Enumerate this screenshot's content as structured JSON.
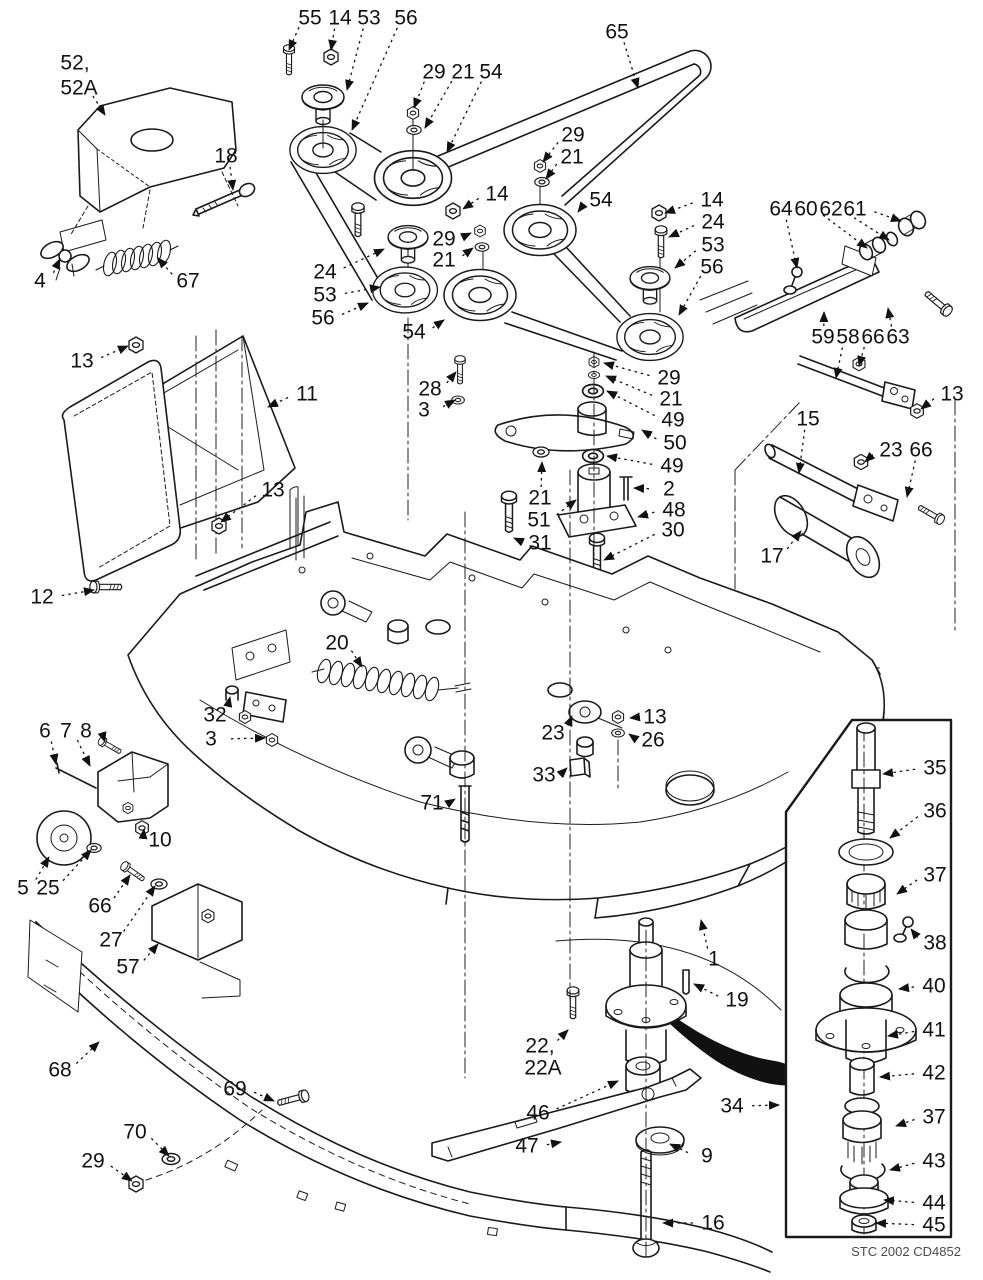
{
  "watermark": {
    "text": "PartsTree",
    "tm": "TM",
    "color": "#c7c7c7"
  },
  "caption": {
    "text": "STC 2002 CD4852"
  },
  "diagram": {
    "line_color": "#1a1a1a",
    "labels": [
      {
        "t": "52,",
        "x": 75,
        "y": 63
      },
      {
        "t": "52A",
        "x": 79,
        "y": 88,
        "ax": 105,
        "ay": 115
      },
      {
        "t": "55",
        "x": 310,
        "y": 18,
        "ax": 289,
        "ay": 50
      },
      {
        "t": "14",
        "x": 340,
        "y": 18,
        "ax": 331,
        "ay": 50
      },
      {
        "t": "53",
        "x": 369,
        "y": 18,
        "ax": 347,
        "ay": 90
      },
      {
        "t": "56",
        "x": 406,
        "y": 18,
        "ax": 352,
        "ay": 130
      },
      {
        "t": "29",
        "x": 434,
        "y": 72,
        "ax": 414,
        "ay": 108
      },
      {
        "t": "21",
        "x": 463,
        "y": 72,
        "ax": 425,
        "ay": 128
      },
      {
        "t": "54",
        "x": 491,
        "y": 72,
        "ax": 447,
        "ay": 152
      },
      {
        "t": "18",
        "x": 226,
        "y": 156,
        "ax": 233,
        "ay": 190
      },
      {
        "t": "65",
        "x": 617,
        "y": 32,
        "ax": 638,
        "ay": 88
      },
      {
        "t": "29",
        "x": 573,
        "y": 135,
        "ax": 543,
        "ay": 162
      },
      {
        "t": "21",
        "x": 572,
        "y": 157,
        "ax": 546,
        "ay": 179
      },
      {
        "t": "14",
        "x": 497,
        "y": 194,
        "ax": 463,
        "ay": 209
      },
      {
        "t": "54",
        "x": 601,
        "y": 200,
        "ax": 578,
        "ay": 212
      },
      {
        "t": "14",
        "x": 712,
        "y": 200,
        "ax": 665,
        "ay": 213
      },
      {
        "t": "24",
        "x": 713,
        "y": 222,
        "ax": 669,
        "ay": 237
      },
      {
        "t": "53",
        "x": 713,
        "y": 245,
        "ax": 675,
        "ay": 268
      },
      {
        "t": "56",
        "x": 712,
        "y": 267,
        "ax": 679,
        "ay": 315
      },
      {
        "t": "64",
        "x": 781,
        "y": 209,
        "ax": 797,
        "ay": 268
      },
      {
        "t": "60",
        "x": 806,
        "y": 209,
        "ax": 867,
        "ay": 248
      },
      {
        "t": "62",
        "x": 831,
        "y": 209,
        "ax": 889,
        "ay": 240
      },
      {
        "t": "61",
        "x": 855,
        "y": 209,
        "ax": 901,
        "ay": 221
      },
      {
        "t": "4",
        "x": 40,
        "y": 281,
        "ax": 60,
        "ay": 259
      },
      {
        "t": "67",
        "x": 188,
        "y": 281,
        "ax": 158,
        "ay": 258
      },
      {
        "t": "24",
        "x": 325,
        "y": 272,
        "ax": 384,
        "ay": 249
      },
      {
        "t": "53",
        "x": 325,
        "y": 295,
        "ax": 380,
        "ay": 287
      },
      {
        "t": "56",
        "x": 323,
        "y": 318,
        "ax": 368,
        "ay": 303
      },
      {
        "t": "29",
        "x": 444,
        "y": 239,
        "ax": 471,
        "ay": 233
      },
      {
        "t": "21",
        "x": 444,
        "y": 260,
        "ax": 473,
        "ay": 248
      },
      {
        "t": "54",
        "x": 414,
        "y": 332,
        "ax": 444,
        "ay": 320
      },
      {
        "t": "13",
        "x": 82,
        "y": 361,
        "ax": 128,
        "ay": 346
      },
      {
        "t": "28",
        "x": 430,
        "y": 389,
        "ax": 456,
        "ay": 372
      },
      {
        "t": "3",
        "x": 424,
        "y": 410,
        "ax": 455,
        "ay": 400
      },
      {
        "t": "11",
        "x": 307,
        "y": 394,
        "ax": 268,
        "ay": 407
      },
      {
        "t": "59",
        "x": 823,
        "y": 337,
        "ax": 824,
        "ay": 312
      },
      {
        "t": "58",
        "x": 848,
        "y": 337,
        "ax": 836,
        "ay": 378
      },
      {
        "t": "66",
        "x": 873,
        "y": 337,
        "ax": 859,
        "ay": 366
      },
      {
        "t": "63",
        "x": 898,
        "y": 337,
        "ax": 888,
        "ay": 308
      },
      {
        "t": "13",
        "x": 952,
        "y": 394,
        "ax": 921,
        "ay": 409
      },
      {
        "t": "29",
        "x": 669,
        "y": 378,
        "ax": 604,
        "ay": 363
      },
      {
        "t": "21",
        "x": 671,
        "y": 399,
        "ax": 606,
        "ay": 376
      },
      {
        "t": "49",
        "x": 673,
        "y": 420,
        "ax": 607,
        "ay": 391
      },
      {
        "t": "50",
        "x": 675,
        "y": 443,
        "ax": 642,
        "ay": 430
      },
      {
        "t": "49",
        "x": 672,
        "y": 466,
        "ax": 607,
        "ay": 456
      },
      {
        "t": "2",
        "x": 669,
        "y": 489,
        "ax": 634,
        "ay": 488
      },
      {
        "t": "48",
        "x": 674,
        "y": 510,
        "ax": 638,
        "ay": 517
      },
      {
        "t": "30",
        "x": 673,
        "y": 530,
        "ax": 604,
        "ay": 560
      },
      {
        "t": "21",
        "x": 540,
        "y": 498,
        "ax": 542,
        "ay": 462
      },
      {
        "t": "51",
        "x": 539,
        "y": 520,
        "ax": 576,
        "ay": 500
      },
      {
        "t": "31",
        "x": 540,
        "y": 543,
        "ax": 514,
        "ay": 538
      },
      {
        "t": "13",
        "x": 273,
        "y": 490,
        "ax": 221,
        "ay": 522
      },
      {
        "t": "15",
        "x": 808,
        "y": 419,
        "ax": 799,
        "ay": 473
      },
      {
        "t": "23",
        "x": 891,
        "y": 450,
        "ax": 865,
        "ay": 462
      },
      {
        "t": "66",
        "x": 921,
        "y": 450,
        "ax": 907,
        "ay": 497
      },
      {
        "t": "17",
        "x": 772,
        "y": 556,
        "ax": 801,
        "ay": 531
      },
      {
        "t": "12",
        "x": 42,
        "y": 597,
        "ax": 94,
        "ay": 590
      },
      {
        "t": "20",
        "x": 337,
        "y": 643,
        "ax": 362,
        "ay": 667
      },
      {
        "t": "32",
        "x": 215,
        "y": 715,
        "ax": 230,
        "ay": 697
      },
      {
        "t": "3",
        "x": 211,
        "y": 739,
        "ax": 265,
        "ay": 738
      },
      {
        "t": "13",
        "x": 655,
        "y": 717,
        "ax": 630,
        "ay": 718
      },
      {
        "t": "26",
        "x": 653,
        "y": 740,
        "ax": 629,
        "ay": 734
      },
      {
        "t": "23",
        "x": 553,
        "y": 733,
        "ax": 572,
        "ay": 716
      },
      {
        "t": "33",
        "x": 544,
        "y": 775,
        "ax": 567,
        "ay": 768
      },
      {
        "t": "71",
        "x": 432,
        "y": 803,
        "ax": 455,
        "ay": 799
      },
      {
        "t": "6",
        "x": 45,
        "y": 731,
        "ax": 56,
        "ay": 764
      },
      {
        "t": "7",
        "x": 66,
        "y": 731,
        "ax": 90,
        "ay": 766
      },
      {
        "t": "8",
        "x": 86,
        "y": 731,
        "ax": 105,
        "ay": 742
      },
      {
        "t": "10",
        "x": 160,
        "y": 840,
        "ax": 144,
        "ay": 829
      },
      {
        "t": "5",
        "x": 23,
        "y": 888,
        "ax": 49,
        "ay": 857
      },
      {
        "t": "25",
        "x": 48,
        "y": 888,
        "ax": 91,
        "ay": 850
      },
      {
        "t": "66",
        "x": 100,
        "y": 906,
        "ax": 130,
        "ay": 875
      },
      {
        "t": "27",
        "x": 111,
        "y": 940,
        "ax": 155,
        "ay": 886
      },
      {
        "t": "57",
        "x": 128,
        "y": 967,
        "ax": 158,
        "ay": 944
      },
      {
        "t": "68",
        "x": 60,
        "y": 1070,
        "ax": 99,
        "ay": 1042
      },
      {
        "t": "69",
        "x": 235,
        "y": 1089,
        "ax": 274,
        "ay": 1101
      },
      {
        "t": "70",
        "x": 135,
        "y": 1132,
        "ax": 169,
        "ay": 1156
      },
      {
        "t": "29",
        "x": 93,
        "y": 1161,
        "ax": 132,
        "ay": 1181
      },
      {
        "t": "1",
        "x": 714,
        "y": 959,
        "ax": 701,
        "ay": 920
      },
      {
        "t": "19",
        "x": 737,
        "y": 1000,
        "ax": 694,
        "ay": 984
      },
      {
        "t": "22,",
        "x": 540,
        "y": 1046,
        "ax": 568,
        "ay": 1030
      },
      {
        "t": "22A",
        "x": 543,
        "y": 1068
      },
      {
        "t": "46",
        "x": 538,
        "y": 1113,
        "ax": 618,
        "ay": 1081
      },
      {
        "t": "47",
        "x": 527,
        "y": 1146,
        "ax": 561,
        "ay": 1142
      },
      {
        "t": "9",
        "x": 707,
        "y": 1156,
        "ax": 670,
        "ay": 1144
      },
      {
        "t": "16",
        "x": 713,
        "y": 1223,
        "ax": 663,
        "ay": 1223
      },
      {
        "t": "34",
        "x": 732,
        "y": 1106,
        "ax": 779,
        "ay": 1105
      },
      {
        "t": "35",
        "x": 935,
        "y": 768,
        "ax": 883,
        "ay": 774
      },
      {
        "t": "36",
        "x": 935,
        "y": 811,
        "ax": 890,
        "ay": 838
      },
      {
        "t": "37",
        "x": 935,
        "y": 875,
        "ax": 897,
        "ay": 894
      },
      {
        "t": "38",
        "x": 935,
        "y": 943,
        "ax": 911,
        "ay": 929
      },
      {
        "t": "40",
        "x": 934,
        "y": 986,
        "ax": 899,
        "ay": 989
      },
      {
        "t": "41",
        "x": 934,
        "y": 1030,
        "ax": 888,
        "ay": 1036
      },
      {
        "t": "42",
        "x": 934,
        "y": 1073,
        "ax": 880,
        "ay": 1077
      },
      {
        "t": "37",
        "x": 934,
        "y": 1117,
        "ax": 896,
        "ay": 1126
      },
      {
        "t": "43",
        "x": 934,
        "y": 1161,
        "ax": 890,
        "ay": 1170
      },
      {
        "t": "44",
        "x": 934,
        "y": 1203,
        "ax": 884,
        "ay": 1200
      },
      {
        "t": "45",
        "x": 934,
        "y": 1225,
        "ax": 876,
        "ay": 1223
      }
    ]
  }
}
